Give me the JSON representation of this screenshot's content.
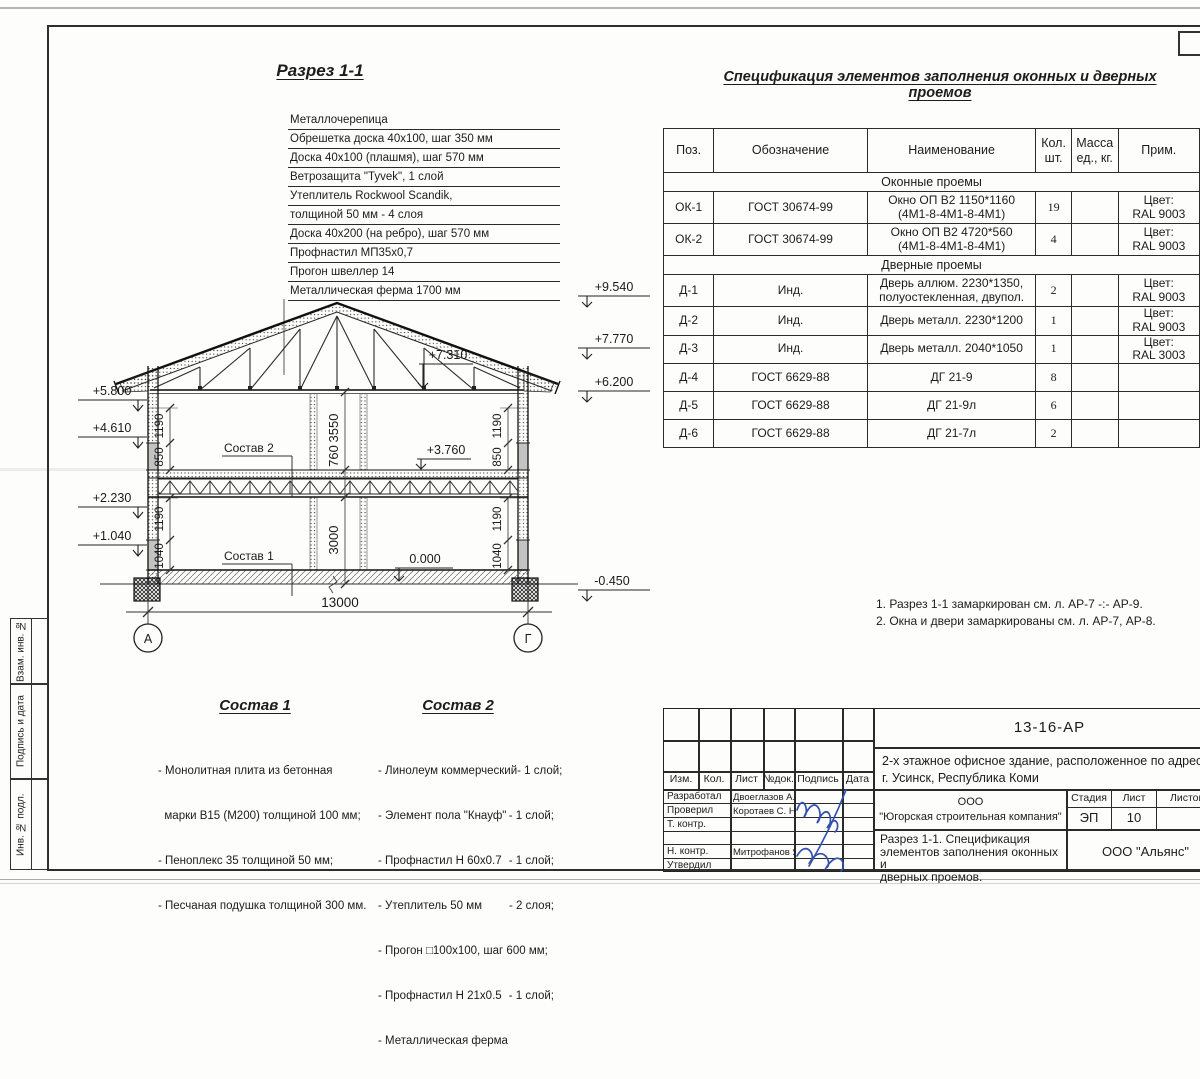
{
  "frame": {
    "sidebar_labels": [
      "Взам. инв. №",
      "Подпись и дата",
      "Инв. № подл."
    ]
  },
  "section": {
    "title": "Разрез 1-1",
    "roof_layers": [
      "Металлочерепица",
      "Обрешетка доска 40х100, шаг 350 мм",
      "Доска 40х100 (плашмя), шаг 570 мм",
      "Ветрозащита \"Tyvek\", 1 слой",
      "Утеплитель Rockwool Scandik,",
      "толщиной 50 мм - 4 слоя",
      "Доска 40х200 (на ребро), шаг 570 мм",
      "Профнастил МП35х0,7",
      "Прогон швеллер 14",
      "Металлическая ферма 1700 мм"
    ],
    "elev": {
      "l1": "+5.800",
      "l2": "+4.610",
      "l3": "+2.230",
      "l4": "+1.040",
      "r1": "+9.540",
      "r2": "+7.770",
      "r3": "+6.200",
      "r4": "-0.450",
      "i1": "+7.310",
      "i2": "+3.760",
      "i3": "0.000"
    },
    "dims": {
      "width": "13000",
      "h2": "3550",
      "hf": "760",
      "h1": "3000",
      "lu1": "1190",
      "lu2": "850",
      "ll1": "1190",
      "ll2": "1040",
      "ru1": "1190",
      "ru2": "850",
      "rl1": "1190",
      "rl2": "1040"
    },
    "axis_a": "А",
    "axis_g": "Г",
    "callout1": "Состав 1",
    "callout2": "Состав 2"
  },
  "spec": {
    "title": "Спецификация элементов заполнения оконных и дверных проемов",
    "h": {
      "pos": "Поз.",
      "des": "Обозначение",
      "name": "Наименование",
      "qty": "Кол.\nшт.",
      "mass": "Масса\nед., кг.",
      "note": "Прим."
    },
    "g1": "Оконные проемы",
    "g2": "Дверные проемы",
    "rows_w": [
      {
        "pos": "ОК-1",
        "des": "ГОСТ 30674-99",
        "name": "Окно ОП В2 1150*1160\n(4М1-8-4М1-8-4М1)",
        "qty": "19",
        "mass": "",
        "note": "Цвет:\nRAL 9003"
      },
      {
        "pos": "ОК-2",
        "des": "ГОСТ 30674-99",
        "name": "Окно ОП В2 4720*560\n(4М1-8-4М1-8-4М1)",
        "qty": "4",
        "mass": "",
        "note": "Цвет:\nRAL 9003"
      }
    ],
    "rows_d": [
      {
        "pos": "Д-1",
        "des": "Инд.",
        "name": "Дверь аллюм. 2230*1350,\nполуостекленная, двупол.",
        "qty": "2",
        "mass": "",
        "note": "Цвет:\nRAL 9003"
      },
      {
        "pos": "Д-2",
        "des": "Инд.",
        "name": "Дверь металл. 2230*1200",
        "qty": "1",
        "mass": "",
        "note": "Цвет:\nRAL 9003"
      },
      {
        "pos": "Д-3",
        "des": "Инд.",
        "name": "Дверь металл. 2040*1050",
        "qty": "1",
        "mass": "",
        "note": "Цвет:\nRAL 3003"
      },
      {
        "pos": "Д-4",
        "des": "ГОСТ 6629-88",
        "name": "ДГ 21-9",
        "qty": "8",
        "mass": "",
        "note": ""
      },
      {
        "pos": "Д-5",
        "des": "ГОСТ 6629-88",
        "name": "ДГ 21-9л",
        "qty": "6",
        "mass": "",
        "note": ""
      },
      {
        "pos": "Д-6",
        "des": "ГОСТ 6629-88",
        "name": "ДГ 21-7л",
        "qty": "2",
        "mass": "",
        "note": ""
      }
    ]
  },
  "notes": [
    "1. Разрез 1-1 замаркирован см. л. АР-7 -:- АР-9.",
    "2. Окна и двери замаркированы см. л. АР-7, АР-8."
  ],
  "sostav1": {
    "title": "Состав 1",
    "items": [
      "- Монолитная плита из бетонная",
      "  марки В15 (М200) толщиной 100 мм;",
      "- Пеноплекс 35 толщиной 50 мм;",
      "- Песчаная подушка толщиной 300 мм."
    ]
  },
  "sostav2": {
    "title": "Состав 2",
    "items": [
      [
        "- Линолеум коммерческий",
        "- 1 слой;"
      ],
      [
        "- Элемент пола \"Кнауф\"",
        "- 1 слой;"
      ],
      [
        "- Профнастил Н 60х0.7",
        "- 1 слой;"
      ],
      [
        "- Утеплитель 50 мм",
        "- 2 слоя;"
      ],
      [
        "- Прогон □100х100, шаг 600 мм;",
        ""
      ],
      [
        "- Профнастил Н 21х0.5",
        "- 1 слой;"
      ],
      [
        "- Металлическая ферма",
        ""
      ]
    ]
  },
  "titleblock": {
    "doc": "13-16-АР",
    "project": "2-х этажное офисное здание, расположенное по адресу:\nг. Усинск, Республика Коми",
    "org": "ООО\n\"Югорская строительная компания\"",
    "sheet_title": "Разрез 1-1. Спецификация\nэлементов заполнения оконных и\nдверных проемов.",
    "contractor": "ООО \"Альянс\"",
    "stage_label": "Стадия",
    "sheet_label": "Лист",
    "sheets_label": "Листов",
    "stage": "ЭП",
    "sheet_no": "10",
    "cols": [
      "Изм.",
      "Кол.",
      "Лист",
      "№док.",
      "Подпись",
      "Дата"
    ],
    "roles": [
      "Разработал",
      "Проверил",
      "Т. контр.",
      "",
      "Н. контр.",
      "Утвердил"
    ],
    "names": [
      "Двоеглазов А. В.",
      "Коротаев С. Н.",
      "",
      "",
      "Митрофанов Я. А.",
      ""
    ]
  },
  "colors": {
    "ink": "#2a2a2a",
    "signature_blue": "#3350b0"
  }
}
